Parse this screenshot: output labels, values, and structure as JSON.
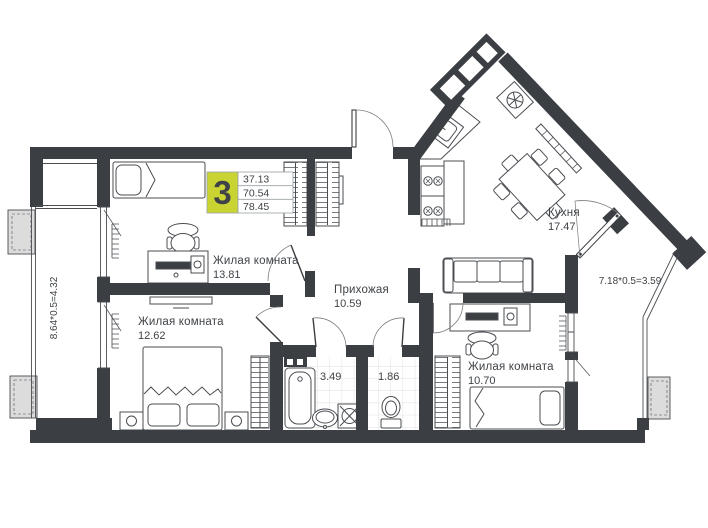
{
  "badge": {
    "room_count": "3",
    "area_living": "37.13",
    "area_apartment": "70.54",
    "area_total": "78.45"
  },
  "rooms": {
    "living1": {
      "name": "Жилая комната",
      "area": "13.81"
    },
    "living2": {
      "name": "Жилая комната",
      "area": "12.62"
    },
    "living3": {
      "name": "Жилая комната",
      "area": "10.70"
    },
    "hallway": {
      "name": "Прихожая",
      "area": "10.59"
    },
    "kitchen": {
      "name": "Кухня",
      "area": "17.47"
    },
    "bathroom": {
      "area": "3.49"
    },
    "wc": {
      "area": "1.86"
    }
  },
  "dimensions": {
    "left_balcony": "8.64*0.5=4.32",
    "right_balcony": "7.18*0.5=3.59"
  },
  "colors": {
    "wall": "#3b3e42",
    "badge": "#c9d433",
    "line": "#4a4d52",
    "tile": "#d6d6d6",
    "text": "#3f4347",
    "ac_fill": "#dcdcdc",
    "arc": "#7a7d80"
  }
}
